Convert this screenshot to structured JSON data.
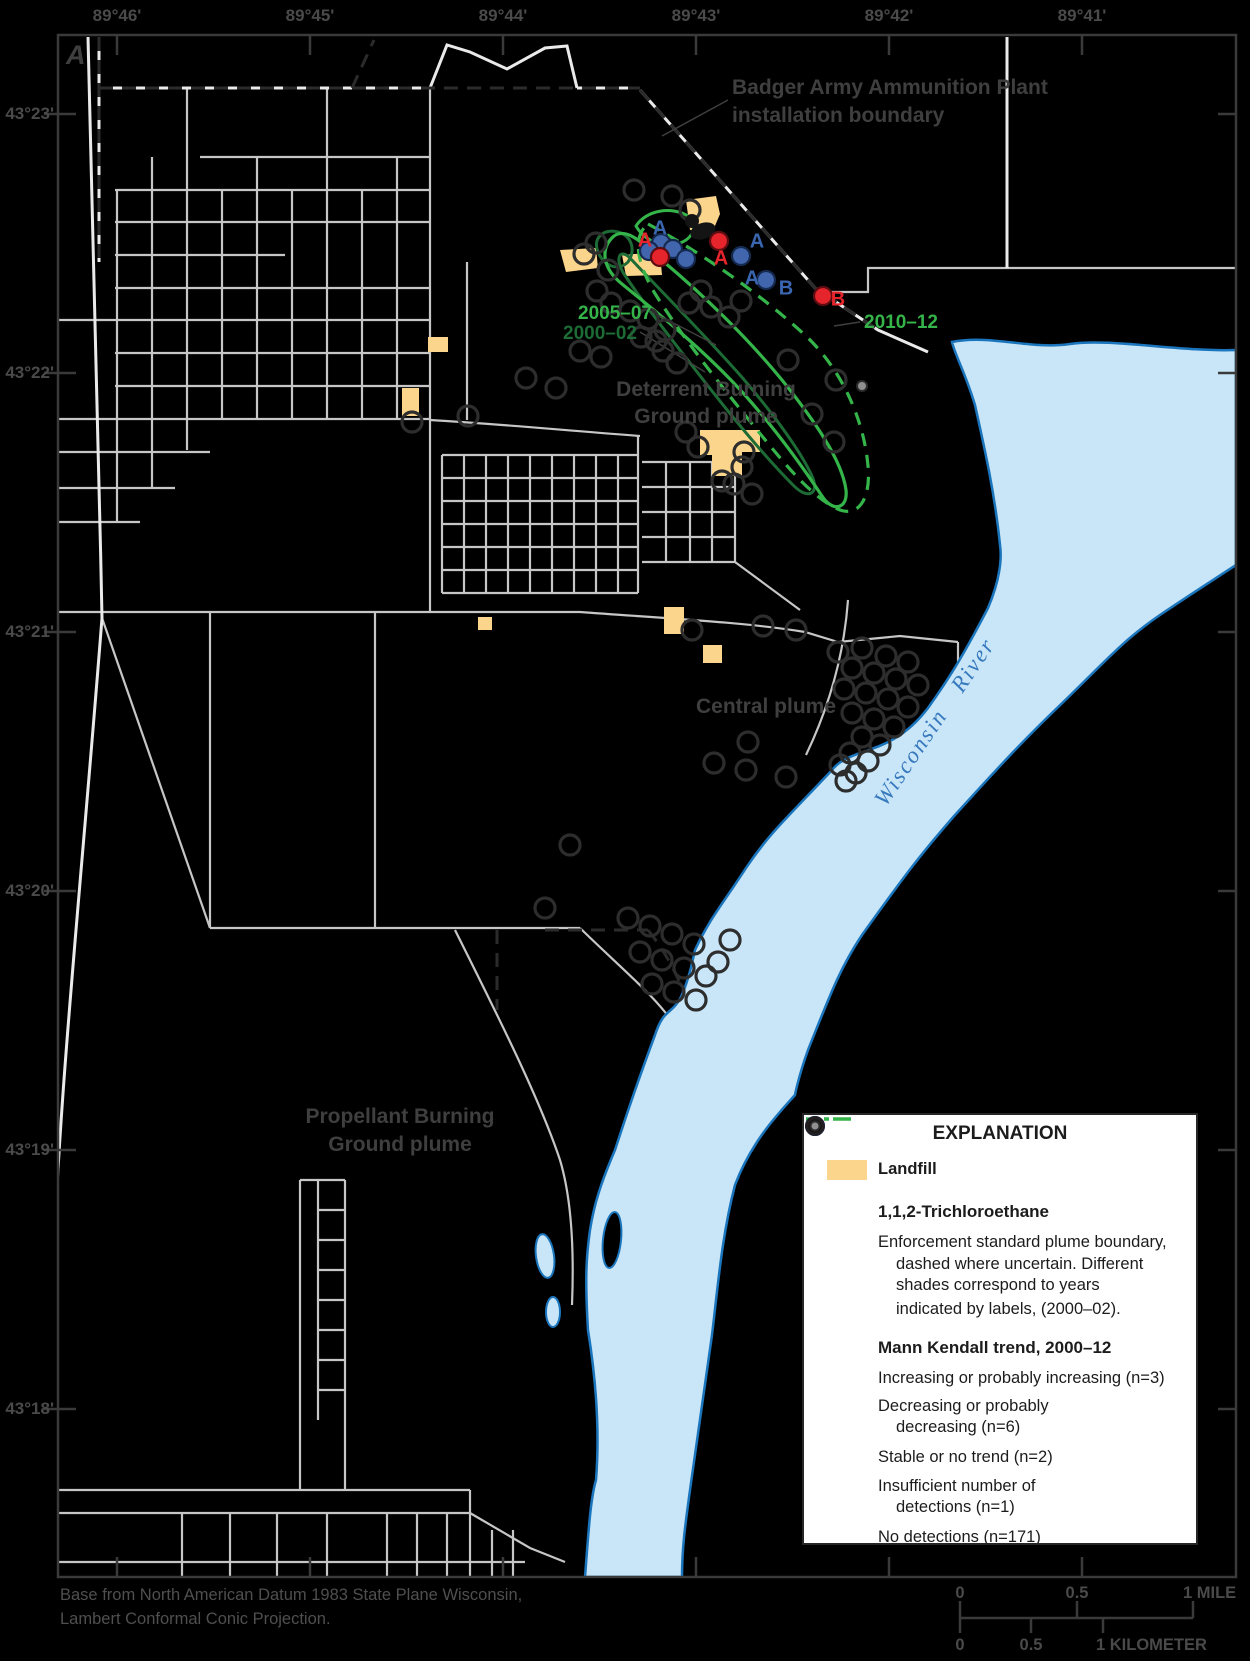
{
  "figure": {
    "panel_label": "A"
  },
  "axes": {
    "top": [
      "89°46'",
      "89°45'",
      "89°44'",
      "89°43'",
      "89°42'",
      "89°41'"
    ],
    "left": [
      "43°23'",
      "43°22'",
      "43°21'",
      "43°20'",
      "43°19'",
      "43°18'"
    ]
  },
  "map_labels": {
    "installation_l1": "Badger Army Ammunition Plant",
    "installation_l2": "installation boundary",
    "deterrent_l1": "Deterrent Burning",
    "deterrent_l2": "Ground plume",
    "central": "Central plume",
    "propellant_l1": "Propellant Burning",
    "propellant_l2": "Ground plume",
    "river": "Wisconsin  River"
  },
  "plume_year_labels": {
    "y2005": "2005–07",
    "y2000": "2000–02",
    "y2010": "2010–12"
  },
  "markers": {
    "increasing": "A",
    "decreasing": "A",
    "increasing_b": "B",
    "decreasing_b": "B"
  },
  "legend": {
    "title": "EXPLANATION",
    "landfill": "Landfill",
    "chemical": "1,1,2-Trichloroethane",
    "plume_l1": "Enforcement standard plume boundary,",
    "plume_l2": "dashed where uncertain. Different",
    "plume_l3": "shades correspond to years",
    "plume_l4": "indicated by labels, (2000–02).",
    "trend": "Mann Kendall trend, 2000–12",
    "increasing": "Increasing or probably increasing (n=3)",
    "decreasing_l1": "Decreasing or probably",
    "decreasing_l2": "decreasing (n=6)",
    "stable": "Stable or no trend (n=2)",
    "insufficient_l1": "Insufficient number of",
    "insufficient_l2": "detections (n=1)",
    "none": "No detections (n=171)"
  },
  "scalebar": {
    "mile_0": "0",
    "mile_05": "0.5",
    "mile_1": "1 MILE",
    "km_0": "0",
    "km_05": "0.5",
    "km_1": "1 KILOMETER"
  },
  "credit": {
    "line1": "Base from North American Datum 1983 State Plane Wisconsin,",
    "line2": "Lambert Conformal Conic Projection."
  },
  "colors": {
    "landfill": "#fbd58b",
    "river_fill": "#c9e6f8",
    "river_stroke": "#1b75bc",
    "plume_bright": "#35b44a",
    "plume_dark": "#1d6b35",
    "increasing_red": "#e5242b",
    "decreasing_blue": "#4166ae",
    "road_gray": "#c6c6c6",
    "boundary_white": "#eaeaea",
    "frame_gray": "#3a3a3a"
  }
}
